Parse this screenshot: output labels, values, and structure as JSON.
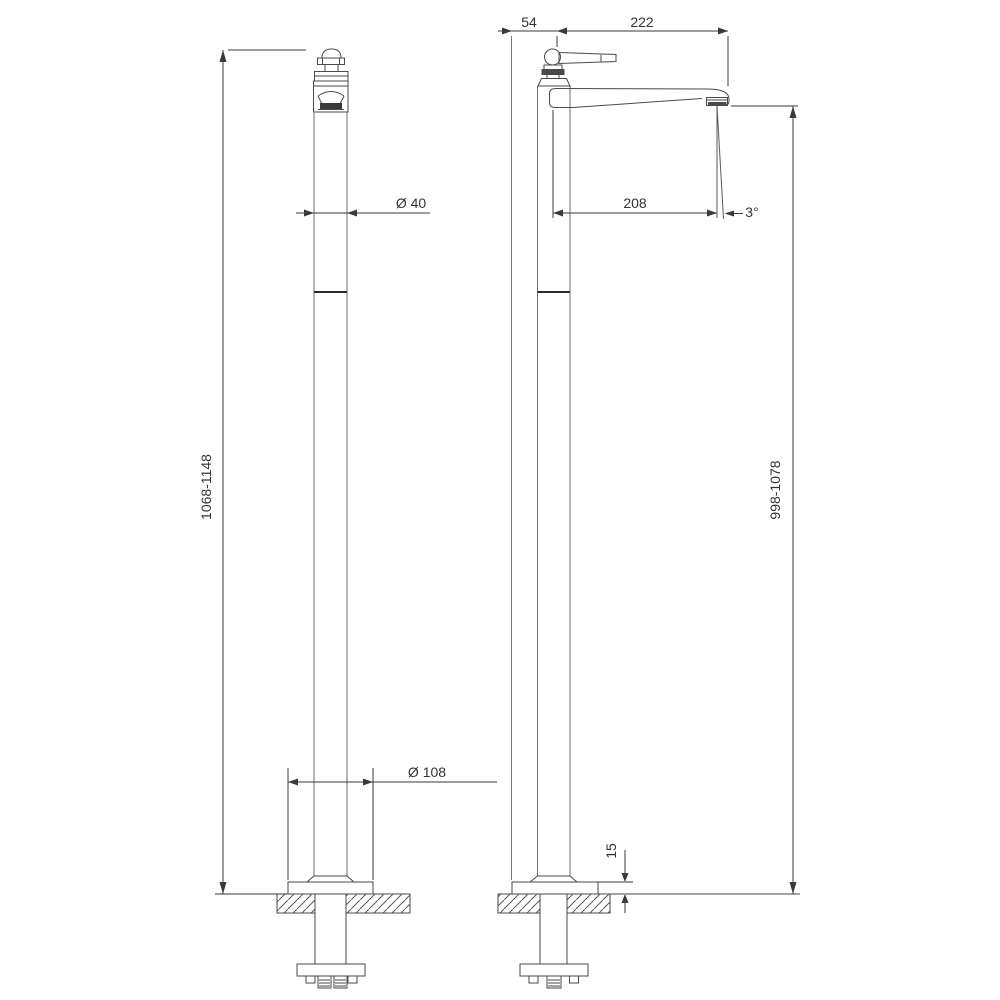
{
  "drawing": {
    "dimensions": {
      "handle_offset": "54",
      "spout_reach": "222",
      "column_diameter": "Ø 40",
      "spout_projection": "208",
      "stream_angle": "3°",
      "overall_height_range": "1068-1148",
      "spout_height_range": "998-1078",
      "base_diameter": "Ø 108",
      "base_plate_height": "15"
    },
    "colors": {
      "object_line": "#4a4a4a",
      "dimension_line": "#3a3a3a",
      "background": "#ffffff"
    }
  }
}
